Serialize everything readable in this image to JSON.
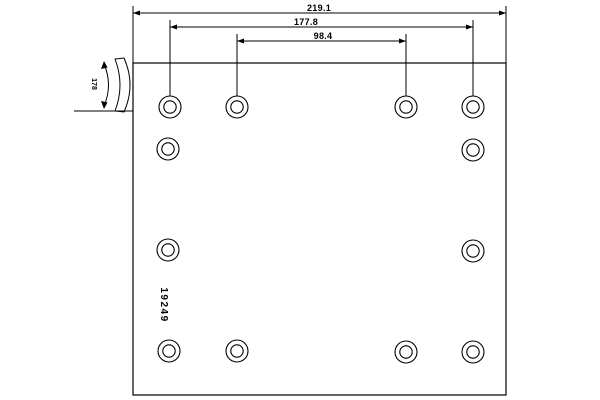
{
  "drawing": {
    "type": "brake-lining-technical-drawing",
    "background_color": "#ffffff",
    "line_color": "#000000",
    "part_number": "19249",
    "part_number_pos": {
      "x": 161,
      "y": 305,
      "rotation": 90
    },
    "outline": {
      "x": 133,
      "y": 63,
      "width": 373,
      "height": 332
    },
    "dimensions": [
      {
        "label": "219.1",
        "y": 13,
        "x1": 133,
        "x2": 506,
        "label_x": 319,
        "label_y": 11,
        "extensions": [
          {
            "x": 133,
            "y1": 6,
            "y2": 63
          },
          {
            "x": 506,
            "y1": 6,
            "y2": 63
          }
        ]
      },
      {
        "label": "177.8",
        "y": 27,
        "x1": 170,
        "x2": 473,
        "label_x": 306,
        "label_y": 25,
        "extensions": [
          {
            "x": 170,
            "y1": 20,
            "y2": 96
          },
          {
            "x": 473,
            "y1": 20,
            "y2": 96
          }
        ]
      },
      {
        "label": "98.4",
        "y": 41,
        "x1": 237,
        "x2": 406,
        "label_x": 323,
        "label_y": 39,
        "extensions": [
          {
            "x": 237,
            "y1": 34,
            "y2": 96
          },
          {
            "x": 406,
            "y1": 34,
            "y2": 96
          }
        ]
      }
    ],
    "holes": {
      "outer_radius": 11,
      "inner_radius": 6.2,
      "positions": [
        [
          170,
          107
        ],
        [
          237,
          107
        ],
        [
          406,
          107
        ],
        [
          473,
          107
        ],
        [
          168,
          149
        ],
        [
          473,
          150
        ],
        [
          168,
          250
        ],
        [
          473,
          251
        ],
        [
          169,
          351
        ],
        [
          237,
          351
        ],
        [
          406,
          352
        ],
        [
          473,
          352
        ]
      ]
    },
    "side_profile": {
      "label": "178",
      "label_pos": {
        "x": 92,
        "y": 84,
        "rotation": 90
      },
      "band_path": "M 115 59 Q 125 85 115 111 L 124 112 Q 136 85 124 58 Z",
      "dim_arc_path": "M 104 64 Q 113 85 104 106",
      "arrow_points": [
        "104,61 101,69 107.5,67.5",
        "104,109 101,101 107.5,102.5"
      ],
      "baseline": {
        "x1": 74,
        "y1": 111,
        "x2": 133,
        "y2": 111
      }
    }
  }
}
